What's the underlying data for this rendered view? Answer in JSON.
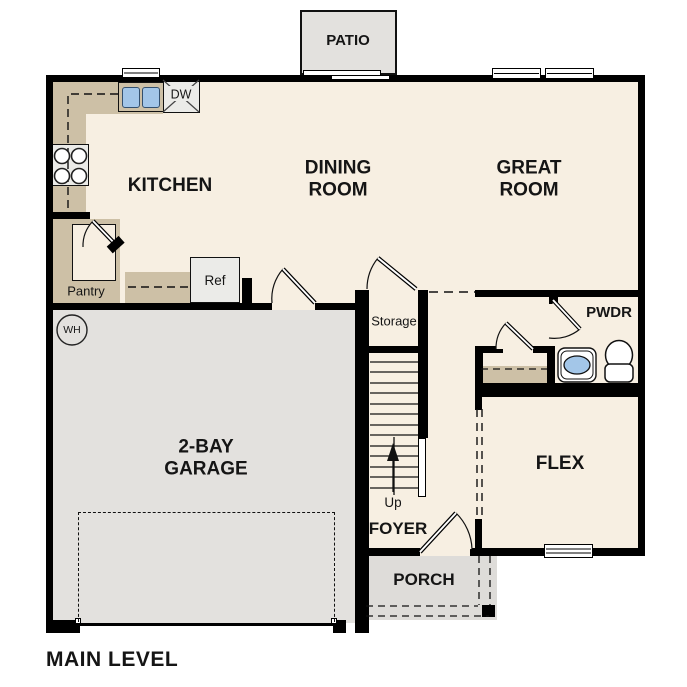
{
  "title": "MAIN LEVEL",
  "rooms": {
    "patio": "PATIO",
    "kitchen": "KITCHEN",
    "dining": "DINING\nROOM",
    "great": "GREAT\nROOM",
    "garage": "2-BAY\nGARAGE",
    "flex": "FLEX",
    "foyer": "FOYER",
    "porch": "PORCH",
    "pwdr": "PWDR",
    "storage": "Storage",
    "pantry": "Pantry"
  },
  "fixtures": {
    "ref": "Ref",
    "dw": "DW",
    "wh": "WH",
    "up": "Up"
  },
  "colors": {
    "floor": "#f7efe2",
    "garage": "#e3e1de",
    "counter": "#cdc0a6",
    "fixture_blue": "#a3c6e8",
    "wall": "#000000"
  }
}
